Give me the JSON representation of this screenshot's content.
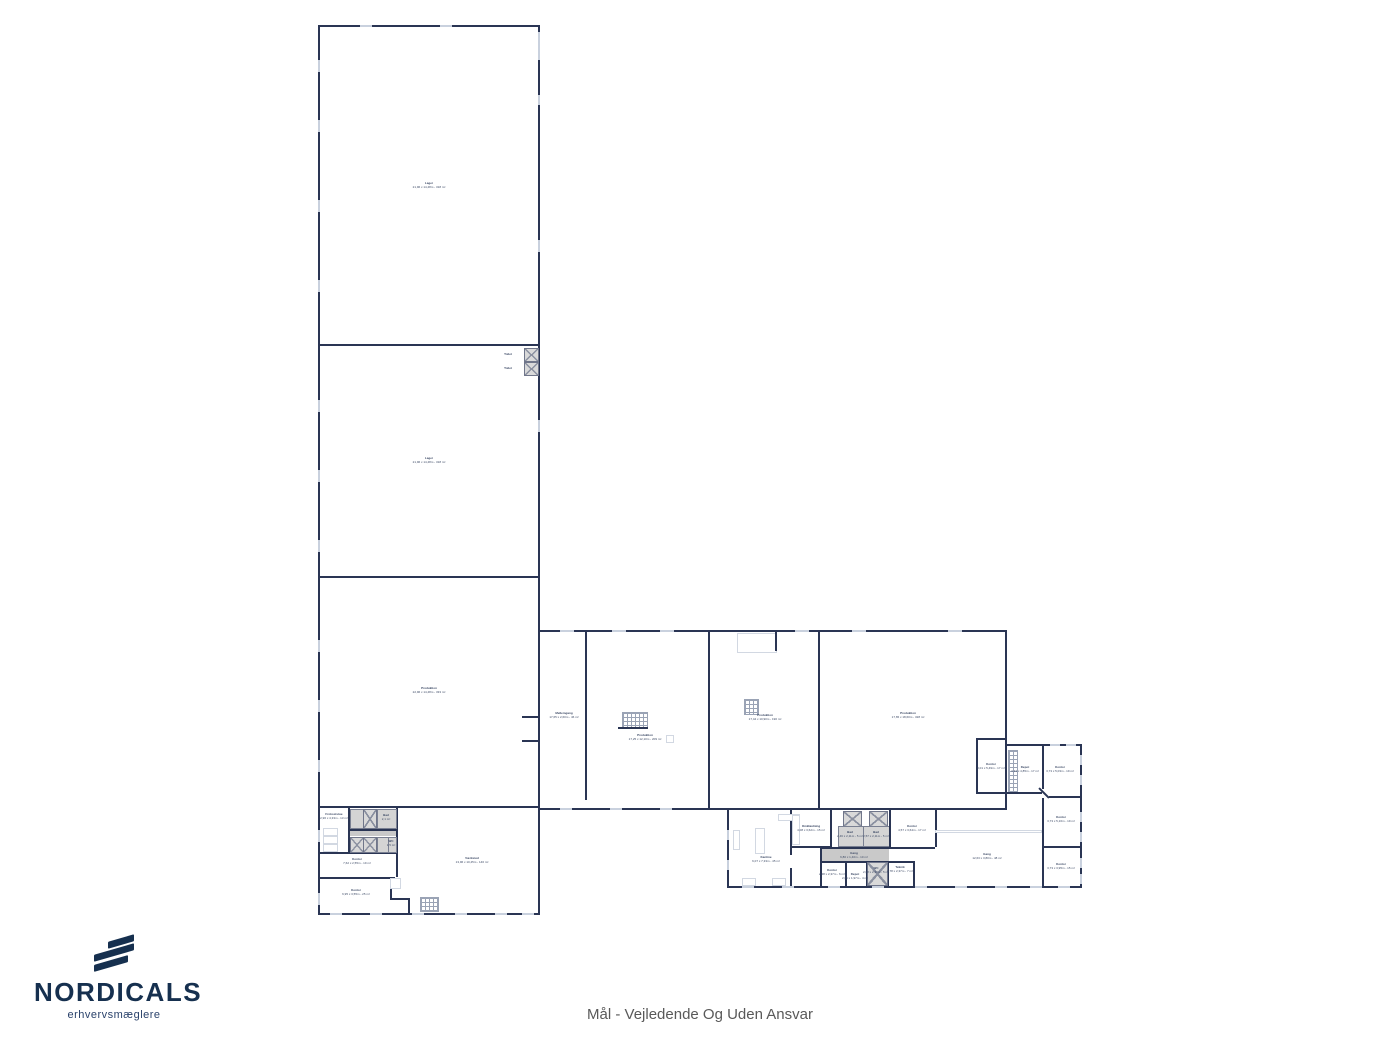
{
  "brand": {
    "name": "NORDICALS",
    "tagline": "erhvervsmæglere"
  },
  "footer": {
    "disclaimer": "Mål - Vejledende Og Uden Ansvar"
  },
  "rooms": {
    "hall1": {
      "name": "Lager",
      "dims": "21,96 x 14,48m - 318 m²"
    },
    "hall2": {
      "name": "Lager",
      "dims": "21,96 x 14,48m - 318 m²"
    },
    "hall3": {
      "name": "Produktion",
      "dims": "22,96 x 14,48m - 333 m²"
    },
    "corridor": {
      "name": "Mellemgang",
      "dims": "17,65 x 2,60m - 46 m²"
    },
    "prod1": {
      "name": "Produktion",
      "dims": "17,25 x 12,10m - 209 m²"
    },
    "prod2": {
      "name": "Produktion",
      "dims": "17,44 x 10,90m - 190 m²"
    },
    "prod3": {
      "name": "Produktion",
      "dims": "17,65 x 18,60m - 328 m²"
    },
    "kontorsq": {
      "name": "Kontor",
      "dims": "3,01 x 5,49m - 17 m²"
    },
    "r1": {
      "name": "Depot",
      "dims": "3,43 x 4,85m - 17 m²"
    },
    "r2": {
      "name": "Kontor",
      "dims": "3,73 x 5,03m - 19 m²"
    },
    "r3": {
      "name": "Kontor",
      "dims": "3,73 x 5,16m - 19 m²"
    },
    "r4": {
      "name": "Kontor",
      "dims": "3,73 x 3,95m - 15 m²"
    },
    "kantine": {
      "name": "Kantine",
      "dims": "6,07 x 7,33m - 45 m²"
    },
    "omklaedning": {
      "name": "Omklædning",
      "dims": "4,08 x 3,62m - 15 m²"
    },
    "bad1": {
      "name": "Bad",
      "dims": "2,46 x 2,11m - 5 m²"
    },
    "bad2": {
      "name": "Bad",
      "dims": "2,57 x 2,11m - 5 m²"
    },
    "kontorO2": {
      "name": "Kontor",
      "dims": "4,57 x 3,64m - 17 m²"
    },
    "gang1": {
      "name": "Gang",
      "dims": "6,80 x 1,40m - 10 m²"
    },
    "kontorO3": {
      "name": "Kontor",
      "dims": "2,48 x 2,37m - 6 m²"
    },
    "depotO4": {
      "name": "Depot",
      "dims": "2,05 x 1,97m - 4 m²"
    },
    "wc1": {
      "name": "WC",
      "dims": "2,08 x 2,37m - 5 m²"
    },
    "teknik": {
      "name": "Teknik",
      "dims": "2,78 x 2,37m - 7 m²"
    },
    "gang2": {
      "name": "Gang",
      "dims": "12,63 x 3,80m - 48 m²"
    },
    "frokost": {
      "name": "Frokoststue",
      "dims": "2,96 x 4,33m - 13 m²"
    },
    "hatch1": {
      "name": "Bad",
      "dims": "2,1 m²"
    },
    "hatch2": {
      "name": "WC",
      "dims": "1,5 m²"
    },
    "kontorA": {
      "name": "Kontor",
      "dims": "7,62 x 2,55m - 19 m²"
    },
    "kontorB": {
      "name": "Kontor",
      "dims": "6,95 x 3,55m - 25 m²"
    },
    "vaerksted": {
      "name": "Værksted",
      "dims": "13,96 x 10,45m - 146 m²"
    },
    "toiletw1": {
      "name": "Toilet",
      "dims": "1,4 m²"
    },
    "toiletw2": {
      "name": "Toilet",
      "dims": "1,4 m²"
    }
  }
}
